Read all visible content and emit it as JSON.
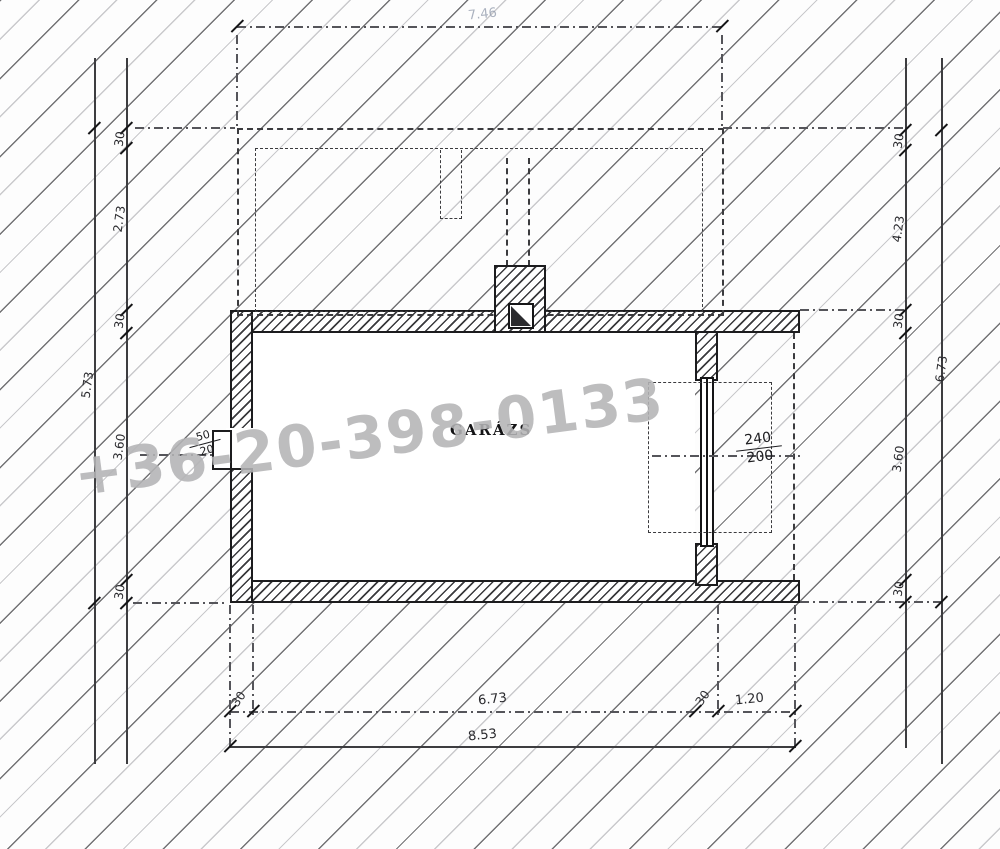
{
  "watermark": {
    "text": "+36-20-398-0133",
    "color": "#b4b4b6"
  },
  "plan": {
    "room_label": "GARÁZS",
    "window_dim": {
      "width": "50",
      "height": "20"
    },
    "door_dim": {
      "width": "240",
      "height": "200"
    }
  },
  "dimensions": {
    "top": {
      "total": "7.46"
    },
    "bottom": {
      "seg1": "30",
      "seg2": "6.73",
      "seg3": "30",
      "seg4": "1.20",
      "total": "8.53"
    },
    "left": {
      "seg1": "30",
      "seg2": "2.73",
      "seg3": "30",
      "seg4": "3.60",
      "seg5": "30",
      "total": "5.73"
    },
    "right": {
      "seg1": "30",
      "seg2": "4.23",
      "seg3": "30",
      "seg4": "3.60",
      "seg5": "30",
      "total": "6.73"
    }
  }
}
